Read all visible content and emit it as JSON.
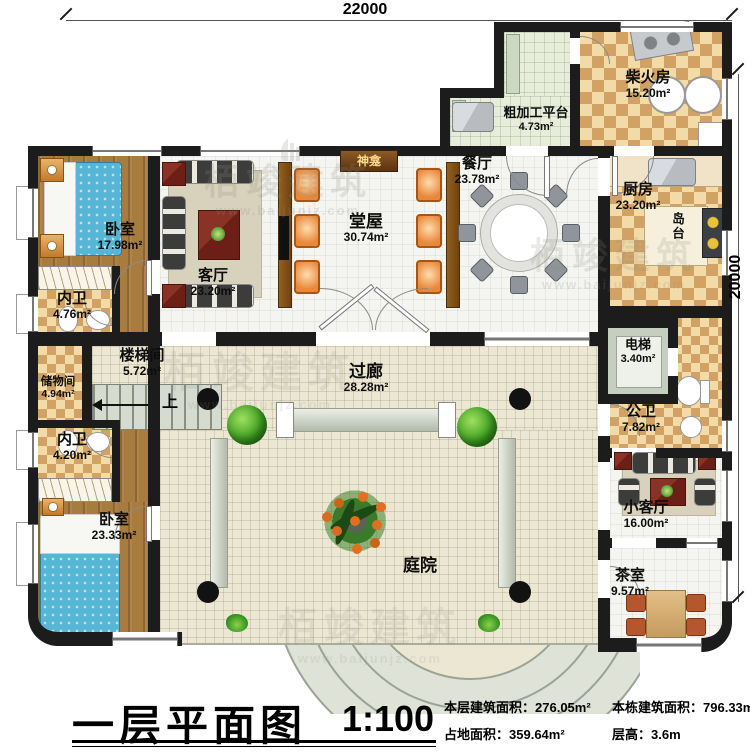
{
  "dimensions": {
    "top": "22000",
    "right": "20000"
  },
  "rooms": {
    "woshi1": {
      "name": "卧室",
      "area": "17.98m²"
    },
    "neiwei1": {
      "name": "内卫",
      "area": "4.76m²"
    },
    "keting": {
      "name": "客厅",
      "area": "23.20m²"
    },
    "tangwu": {
      "name": "堂屋",
      "area": "30.74m²"
    },
    "canting": {
      "name": "餐厅",
      "area": "23.78m²"
    },
    "cujiagong": {
      "name": "粗加工平台",
      "area": "4.73m²"
    },
    "chaihuofang": {
      "name": "柴火房",
      "area": "15.20m²"
    },
    "chufang": {
      "name": "厨房",
      "area": "23.20m²"
    },
    "loutijian": {
      "name": "楼梯间",
      "area": "5.72m²"
    },
    "chuwujian": {
      "name": "储物间",
      "area": "4.94m²"
    },
    "neiwei2": {
      "name": "内卫",
      "area": "4.20m²"
    },
    "woshi2": {
      "name": "卧室",
      "area": "23.33m²"
    },
    "guolang": {
      "name": "过廊",
      "area": "28.28m²"
    },
    "dianti": {
      "name": "电梯",
      "area": "3.40m²"
    },
    "gongwei": {
      "name": "公卫",
      "area": "7.82m²"
    },
    "xiaoketing": {
      "name": "小客厅",
      "area": "16.00m²"
    },
    "chashi": {
      "name": "茶室",
      "area": "9.57m²"
    },
    "tingyuan": {
      "name": "庭院"
    },
    "shenkan": {
      "name": "神龛"
    },
    "daotai": {
      "name": "岛台"
    }
  },
  "annotations": {
    "up": "上"
  },
  "watermark": {
    "brand": "栢竣建筑",
    "site": "www.baijunjz.com"
  },
  "title_block": {
    "title": "一层平面图",
    "scale": "1:100",
    "stats": [
      {
        "label": "本层建筑面积：",
        "value": "276.05m²"
      },
      {
        "label": "本栋建筑面积：",
        "value": "796.33m²"
      },
      {
        "label": "占地面积：",
        "value": "359.64m²"
      },
      {
        "label": "层高：",
        "value": "3.6m"
      }
    ]
  },
  "colors": {
    "wall": "#1c1c1c",
    "wood": "#a87c3e",
    "checker": "#d2a265",
    "cream_tile": "#ece7d3",
    "accent_chair": "#e8883a",
    "bed": "#57b6d6"
  }
}
